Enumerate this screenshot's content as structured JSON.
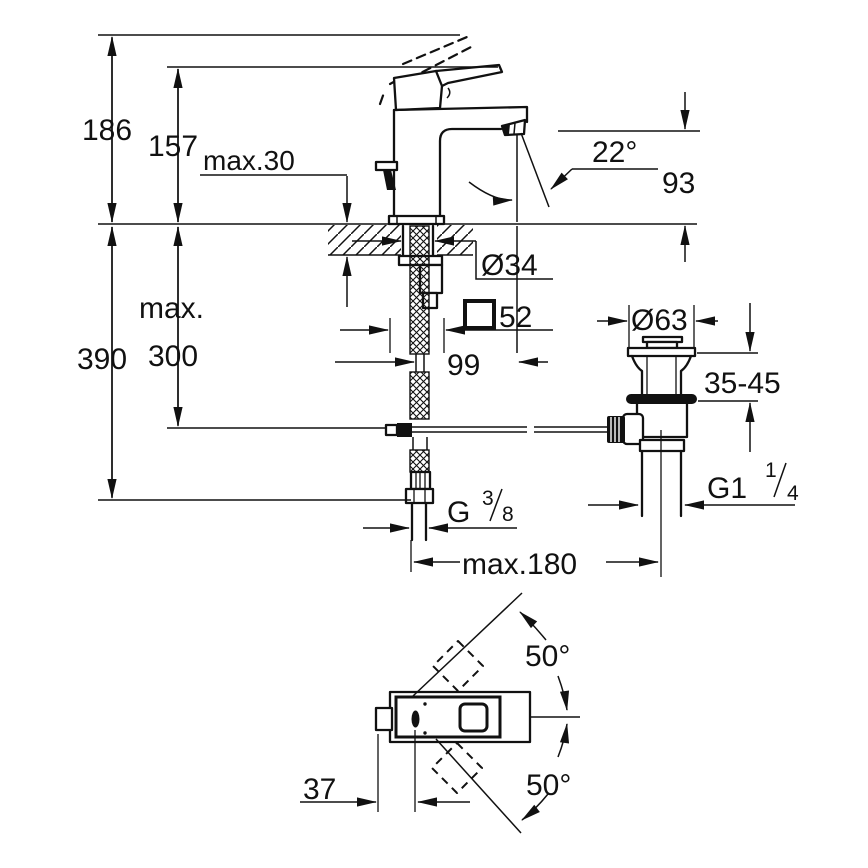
{
  "front_view": {
    "dims": {
      "total_height": "186",
      "spout_body_height": "157",
      "max_deck_thickness": "max.30",
      "spout_angle": "22°",
      "spout_outlet_height": "93",
      "under_max_label": "max.",
      "under_max_value": "300",
      "under_total_height": "390",
      "shank_diameter": "Ø34",
      "body_square_value": "52",
      "spout_projection": "99",
      "waste_flange_diameter": "Ø63",
      "basin_thickness_range": "35-45",
      "rod_span": "max.180"
    },
    "threads": {
      "waste_thread_base": "G1",
      "waste_thread_numerator": "1",
      "waste_thread_denominator": "4",
      "supply_thread_base": "G",
      "supply_thread_numerator": "3",
      "supply_thread_denominator": "8"
    }
  },
  "top_view": {
    "dims": {
      "swivel_angle_upper": "50°",
      "swivel_angle_lower": "50°",
      "lever_offset": "37"
    }
  }
}
